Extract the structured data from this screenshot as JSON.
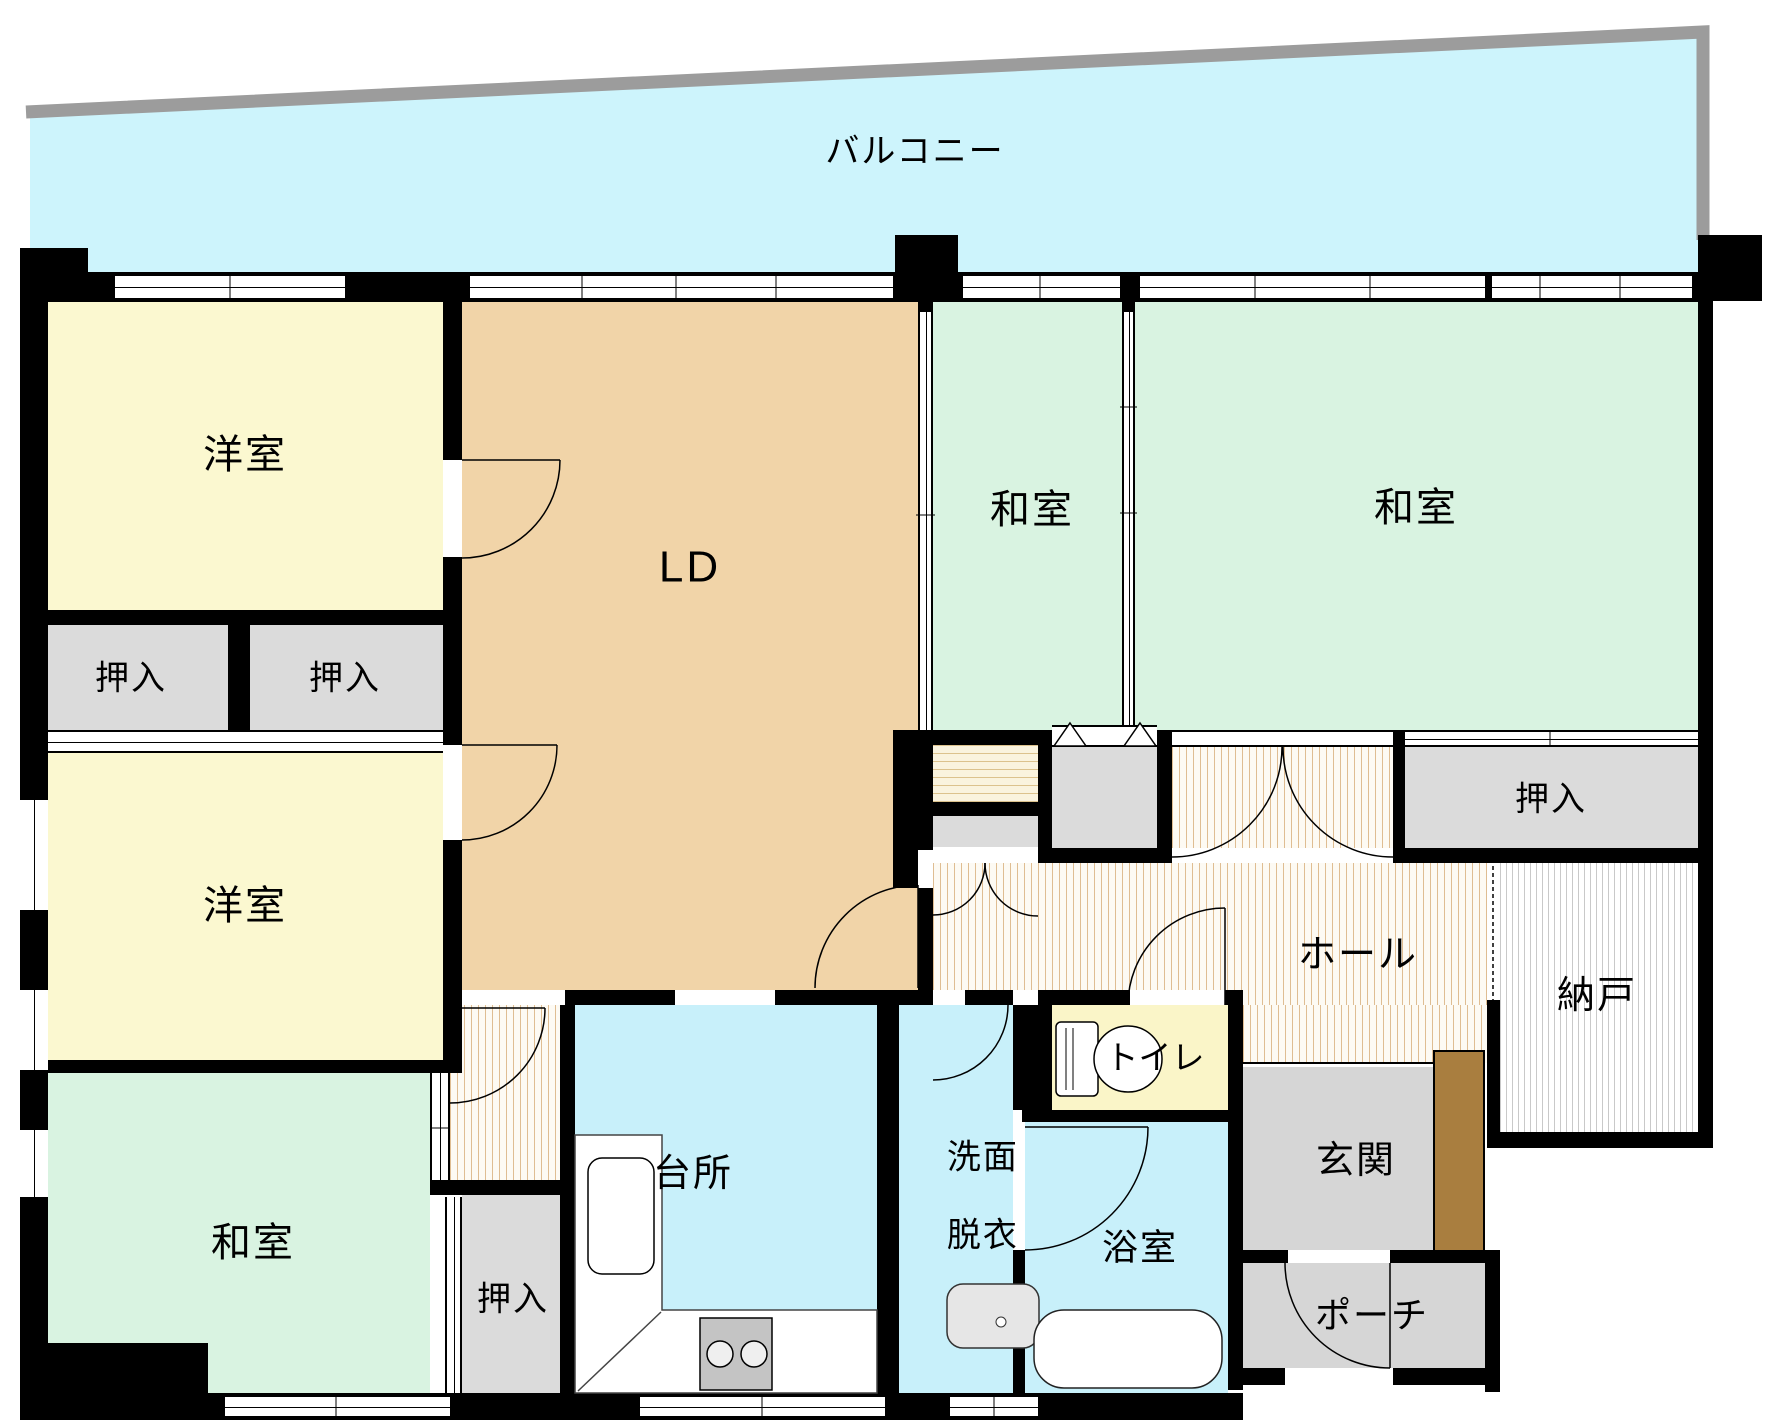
{
  "plan_title": "マンション間取り図",
  "rooms": {
    "balcony": {
      "label": "バルコニー"
    },
    "western1": {
      "label": "洋室"
    },
    "western2": {
      "label": "洋室"
    },
    "closet_l1": {
      "label": "押入"
    },
    "closet_l2": {
      "label": "押入"
    },
    "washitsu_bl": {
      "label": "和室"
    },
    "ld": {
      "label": "LD"
    },
    "washitsu_mid": {
      "label": "和室"
    },
    "washitsu_right": {
      "label": "和室"
    },
    "closet_right": {
      "label": "押入"
    },
    "closet_bottom": {
      "label": "押入"
    },
    "nando": {
      "label": "納戸"
    },
    "hall": {
      "label": "ホール"
    },
    "toilet": {
      "label": "トイレ"
    },
    "bath": {
      "label": "浴室"
    },
    "washroom": {
      "line1": "洗面",
      "line2": "脱衣"
    },
    "kitchen": {
      "label": "台所"
    },
    "genkan": {
      "label": "玄関"
    },
    "porch": {
      "label": "ポーチ"
    }
  },
  "fixtures": {
    "toilet": "toilet-icon",
    "bathtub": "bathtub-icon",
    "washbasin": "washbasin-icon",
    "kitchen_sink": "kitchen-sink-icon",
    "stove": "stove-icon",
    "shoe_cabinet": "shoe-cabinet",
    "balcony_rail": "balcony-rail"
  },
  "colors": {
    "wall": "#000000",
    "balcony_fill": "#cdf4fc",
    "water_room_fill": "#c8f0fa",
    "western_room_fill": "#fbf8d0",
    "toilet_fill": "#faf5c8",
    "japanese_room_fill": "#d9f3e1",
    "living_fill": "#f1d4a8",
    "closet_fill": "#dbdbdb",
    "entrance_fill": "#d6d6d6",
    "cabinet_brown": "#a97e3f",
    "rail_gray": "#9c9c9c",
    "hall_hatch_line": "#dfbd92",
    "nando_hatch_line": "#c9c9c9"
  }
}
